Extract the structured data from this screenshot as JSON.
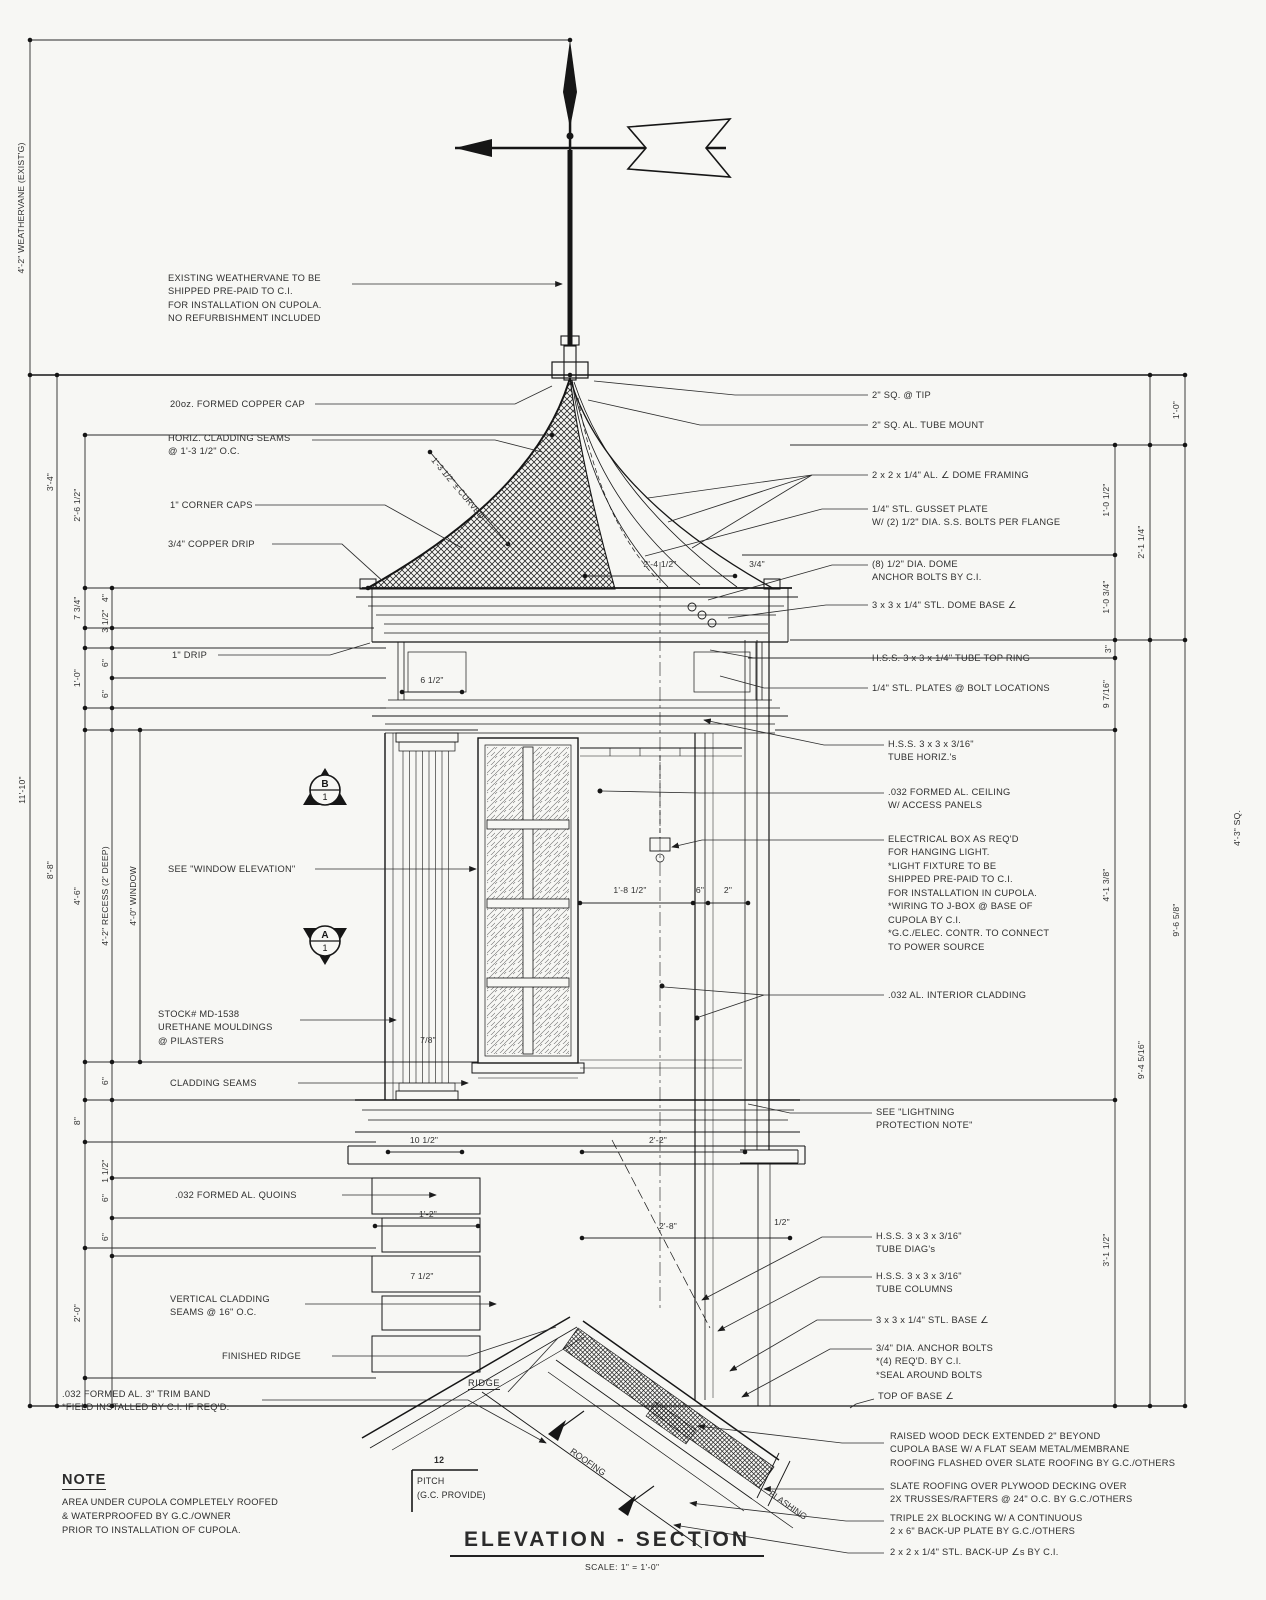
{
  "sheet": {
    "title": "ELEVATION - SECTION",
    "scale": "SCALE: 1\" = 1'-0\""
  },
  "note": {
    "heading": "NOTE",
    "lines": [
      "AREA UNDER CUPOLA COMPLETELY ROOFED",
      "& WATERPROOFED BY G.C./OWNER",
      "PRIOR TO INSTALLATION OF CUPOLA."
    ]
  },
  "annotations": {
    "left": [
      {
        "id": "weathervane-note",
        "lines": [
          "EXISTING WEATHERVANE TO BE",
          "SHIPPED PRE-PAID TO C.I.",
          "FOR INSTALLATION ON CUPOLA.",
          "NO REFURBISHMENT INCLUDED"
        ]
      },
      {
        "id": "copper-cap",
        "lines": [
          "20oz. FORMED COPPER CAP"
        ]
      },
      {
        "id": "horiz-cladding-seams",
        "lines": [
          "HORIZ. CLADDING SEAMS",
          "@ 1'-3 1/2\" O.C."
        ]
      },
      {
        "id": "corner-caps",
        "lines": [
          "1\" CORNER CAPS"
        ]
      },
      {
        "id": "copper-drip",
        "lines": [
          "3/4\" COPPER DRIP"
        ]
      },
      {
        "id": "one-inch-drip",
        "lines": [
          "1\" DRIP"
        ]
      },
      {
        "id": "window-elevation",
        "lines": [
          "SEE \"WINDOW ELEVATION\""
        ]
      },
      {
        "id": "urethane-mouldings",
        "lines": [
          "STOCK# MD-1538",
          "URETHANE MOULDINGS",
          "@ PILASTERS"
        ]
      },
      {
        "id": "cladding-seams",
        "lines": [
          "CLADDING SEAMS"
        ]
      },
      {
        "id": "quoins",
        "lines": [
          ".032 FORMED AL. QUOINS"
        ]
      },
      {
        "id": "vertical-cladding-seams",
        "lines": [
          "VERTICAL CLADDING",
          "SEAMS @ 16\" O.C."
        ]
      },
      {
        "id": "finished-ridge",
        "lines": [
          "FINISHED RIDGE"
        ]
      },
      {
        "id": "trim-band",
        "lines": [
          ".032 FORMED AL. 3\" TRIM BAND",
          "*FIELD INSTALLED BY C.I. IF REQ'D."
        ]
      }
    ],
    "right": [
      {
        "id": "sq-tip",
        "lines": [
          "2\" SQ. @ TIP"
        ]
      },
      {
        "id": "tube-mount",
        "lines": [
          "2\" SQ. AL. TUBE MOUNT"
        ]
      },
      {
        "id": "dome-framing",
        "lines": [
          "2 x 2 x 1/4\" AL. ∠ DOME FRAMING"
        ]
      },
      {
        "id": "gusset-plate",
        "lines": [
          "1/4\" STL. GUSSET PLATE",
          "W/ (2) 1/2\" DIA. S.S. BOLTS PER FLANGE"
        ]
      },
      {
        "id": "dome-anchor-bolts",
        "lines": [
          "(8) 1/2\" DIA. DOME",
          "ANCHOR BOLTS BY C.I."
        ]
      },
      {
        "id": "dome-base-angle",
        "lines": [
          "3 x 3 x 1/4\" STL. DOME BASE ∠"
        ]
      },
      {
        "id": "tube-top-ring",
        "lines": [
          "H.S.S. 3 x 3 x 1/4\" TUBE TOP RING"
        ]
      },
      {
        "id": "stl-plates",
        "lines": [
          "1/4\" STL. PLATES @ BOLT LOCATIONS"
        ]
      },
      {
        "id": "tube-horiz",
        "lines": [
          "H.S.S. 3 x 3 x 3/16\"",
          "TUBE HORIZ.'s"
        ]
      },
      {
        "id": "al-ceiling",
        "lines": [
          ".032 FORMED AL. CEILING",
          "W/ ACCESS PANELS"
        ]
      },
      {
        "id": "electrical-box",
        "lines": [
          "ELECTRICAL BOX AS REQ'D",
          "FOR HANGING LIGHT.",
          "*LIGHT FIXTURE TO BE",
          "SHIPPED PRE-PAID TO C.I.",
          "FOR INSTALLATION IN CUPOLA.",
          "*WIRING TO J-BOX @ BASE OF",
          "CUPOLA BY C.I.",
          "*G.C./ELEC. CONTR. TO CONNECT",
          "TO POWER SOURCE"
        ]
      },
      {
        "id": "interior-cladding",
        "lines": [
          ".032 AL. INTERIOR CLADDING"
        ]
      },
      {
        "id": "lightning-note",
        "lines": [
          "SEE \"LIGHTNING",
          "PROTECTION NOTE\""
        ]
      },
      {
        "id": "tube-diags",
        "lines": [
          "H.S.S. 3 x 3 x 3/16\"",
          "TUBE DIAG's"
        ]
      },
      {
        "id": "tube-columns",
        "lines": [
          "H.S.S. 3 x 3 x 3/16\"",
          "TUBE COLUMNS"
        ]
      },
      {
        "id": "stl-base-angle",
        "lines": [
          "3 x 3 x 1/4\" STL. BASE ∠"
        ]
      },
      {
        "id": "anchor-bolts",
        "lines": [
          "3/4\" DIA. ANCHOR BOLTS",
          "*(4) REQ'D. BY C.I.",
          "*SEAL AROUND BOLTS"
        ]
      },
      {
        "id": "top-of-base-angle",
        "lines": [
          "TOP OF BASE ∠"
        ]
      },
      {
        "id": "raised-wood-deck",
        "lines": [
          "RAISED WOOD DECK EXTENDED 2\" BEYOND",
          "CUPOLA BASE W/ A FLAT SEAM METAL/MEMBRANE",
          "ROOFING FLASHED OVER SLATE ROOFING BY G.C./OTHERS"
        ]
      },
      {
        "id": "slate-roofing",
        "lines": [
          "SLATE ROOFING OVER PLYWOOD DECKING OVER",
          "2X TRUSSES/RAFTERS @ 24\" O.C. BY G.C./OTHERS"
        ]
      },
      {
        "id": "triple-blocking",
        "lines": [
          "TRIPLE 2X BLOCKING W/ A CONTINUOUS",
          "2 x 6\" BACK-UP PLATE BY G.C./OTHERS"
        ]
      },
      {
        "id": "backup-angles",
        "lines": [
          "2 x 2 x 1/4\" STL. BACK-UP ∠s BY C.I."
        ]
      }
    ]
  },
  "dims": {
    "left": [
      {
        "value": "4'-2\" WEATHERVANE (EXIST'G)"
      },
      {
        "value": "3'-4\""
      },
      {
        "value": "11'-10\""
      },
      {
        "value": "8'-8\""
      },
      {
        "value": "2'-6 1/2\""
      },
      {
        "value": "7 3/4\""
      },
      {
        "value": "4\""
      },
      {
        "value": "3 1/2\""
      },
      {
        "value": "1'-0\""
      },
      {
        "value": "6\""
      },
      {
        "value": "6\""
      },
      {
        "value": "4'-6\""
      },
      {
        "value": "4'-2\" RECESS (2' DEEP)"
      },
      {
        "value": "4'-0\" WINDOW"
      },
      {
        "value": "6\""
      },
      {
        "value": "8\""
      },
      {
        "value": "1 1/2\""
      },
      {
        "value": "6\""
      },
      {
        "value": "6\""
      },
      {
        "value": "2'-0\""
      }
    ],
    "right": [
      {
        "value": "1'-0\""
      },
      {
        "value": "1'-0 1/2\""
      },
      {
        "value": "2'-1 1/4\""
      },
      {
        "value": "1'-0 3/4\""
      },
      {
        "value": "3\""
      },
      {
        "value": "9 7/16\""
      },
      {
        "value": "4'-1 3/8\""
      },
      {
        "value": "9'-4 5/16\""
      },
      {
        "value": "9'-6 5/8\""
      },
      {
        "value": "3'-1 1/2\""
      },
      {
        "value": "4'-3\" SQ."
      }
    ],
    "interior": [
      {
        "value": "2'-4 1/2\""
      },
      {
        "value": "3/4\""
      },
      {
        "value": "6 1/2\""
      },
      {
        "value": "1'-8 1/2\""
      },
      {
        "value": "6\""
      },
      {
        "value": "2\""
      },
      {
        "value": "7/8\""
      },
      {
        "value": "10 1/2\""
      },
      {
        "value": "2'-2\""
      },
      {
        "value": "1'-2\""
      },
      {
        "value": "7 1/2\""
      },
      {
        "value": "2'-8\""
      },
      {
        "value": "1/2\""
      }
    ],
    "dome_seam": "1'-3 1/2\" ± CURVED"
  },
  "pitch": {
    "rise": "12",
    "label": "PITCH",
    "provide": "(G.C. PROVIDE)"
  },
  "roof_labels": {
    "ridge": "RIDGE",
    "roofing": "ROOFING",
    "flashing": "FLASHING"
  },
  "section_markers": [
    {
      "letter": "B",
      "number": "1"
    },
    {
      "letter": "A",
      "number": "1"
    }
  ]
}
